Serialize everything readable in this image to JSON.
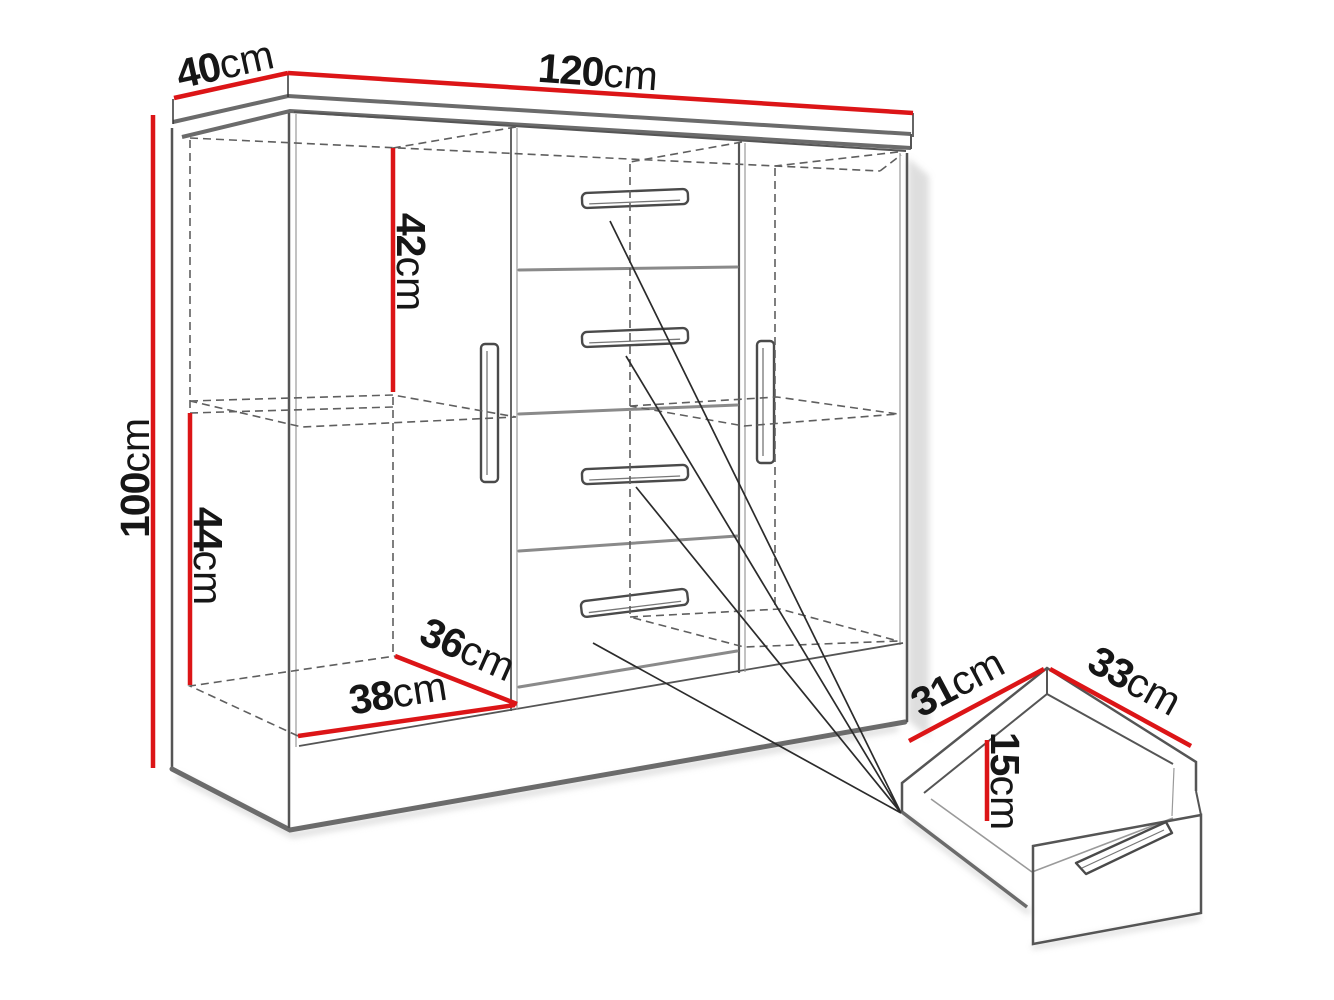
{
  "dimensions": {
    "top_length": {
      "value": "120",
      "unit": "cm"
    },
    "top_depth": {
      "value": "40",
      "unit": "cm"
    },
    "overall_height": {
      "value": "100",
      "unit": "cm"
    },
    "upper_section_height": {
      "value": "42",
      "unit": "cm"
    },
    "lower_section_height": {
      "value": "44",
      "unit": "cm"
    },
    "interior_depth": {
      "value": "36",
      "unit": "cm"
    },
    "interior_width": {
      "value": "38",
      "unit": "cm"
    },
    "drawer_depth": {
      "value": "31",
      "unit": "cm"
    },
    "drawer_width": {
      "value": "33",
      "unit": "cm"
    },
    "drawer_height": {
      "value": "15",
      "unit": "cm"
    }
  },
  "colors": {
    "dimension_line": "#dc1517",
    "outline_strong": "#6b6b6b",
    "outline": "#555555",
    "background": "#ffffff"
  }
}
